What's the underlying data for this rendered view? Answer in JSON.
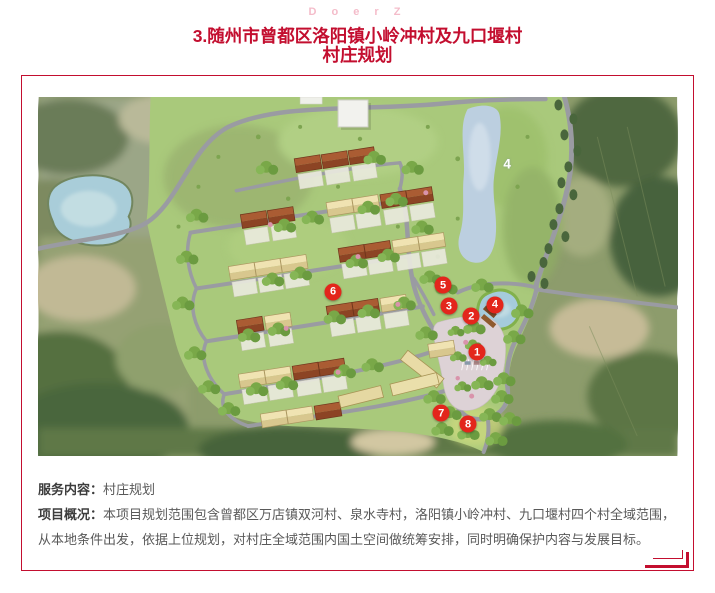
{
  "watermark": "D o e r Z",
  "title": {
    "line1": "3.随州市曾都区洛阳镇小岭冲村及九口堰村",
    "line2": "村庄规划"
  },
  "colors": {
    "accent": "#c30e2f",
    "marker": "#e3261c",
    "watermark": "#f4bcca"
  },
  "map": {
    "lake_label": {
      "text": "4",
      "x": 73.3,
      "y": 18.6
    },
    "markers": [
      {
        "label": "1",
        "x": 68.6,
        "y": 71.1
      },
      {
        "label": "2",
        "x": 67.7,
        "y": 61.1
      },
      {
        "label": "3",
        "x": 64.2,
        "y": 58.3
      },
      {
        "label": "4",
        "x": 71.4,
        "y": 57.8
      },
      {
        "label": "5",
        "x": 63.3,
        "y": 52.5
      },
      {
        "label": "6",
        "x": 46.1,
        "y": 54.2
      },
      {
        "label": "7",
        "x": 63.0,
        "y": 88.1
      },
      {
        "label": "8",
        "x": 67.2,
        "y": 91.1
      }
    ]
  },
  "details": {
    "service_label": "服务内容：",
    "service_value": "村庄规划",
    "overview_label": "项目概况：",
    "overview_value": "本项目规划范围包含曾都区万店镇双河村、泉水寺村，洛阳镇小岭冲村、九口堰村四个村全域范围，从本地条件出发，依据上位规划，对村庄全域范围内国土空间做统筹安排，同时明确保护内容与发展目标。"
  }
}
